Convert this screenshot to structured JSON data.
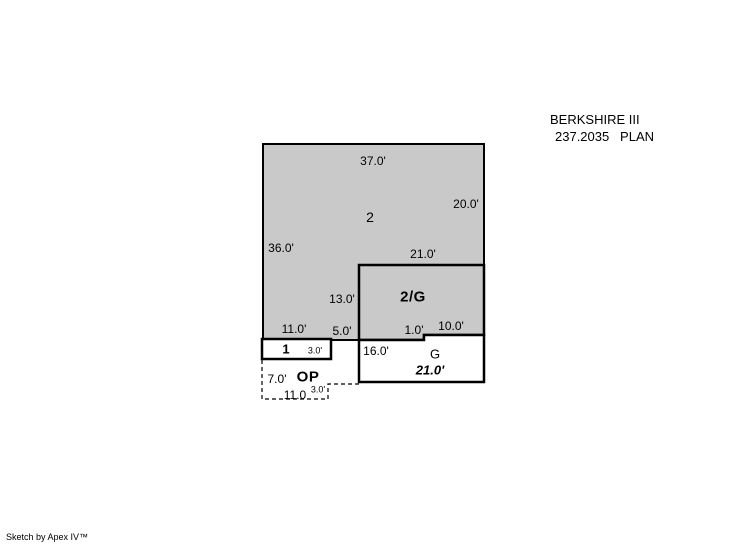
{
  "header": {
    "model_name": "BERKSHIRE III",
    "plan_line": "237.2035   PLAN"
  },
  "footer": {
    "credit": "Sketch by Apex IV™"
  },
  "colors": {
    "area_fill": "#c9c9c9",
    "open_fill": "#ffffff",
    "line": "#000000"
  },
  "areas": {
    "main_floor": "2",
    "over_garage": "2/G",
    "porch": "1",
    "garage": "G",
    "open_porch": "OP"
  },
  "dims": {
    "top_width": "37.0'",
    "right_upper": "20.0'",
    "left_height": "36.0'",
    "og_top": "21.0'",
    "og_left": "13.0'",
    "porch_top": "11.0'",
    "ledge": "5.0'",
    "step": "1.0'",
    "g_top_right": "10.0'",
    "porch_height": "3.0'",
    "g_left": "16.0'",
    "g_bottom": "21.0'",
    "op_left": "7.0'",
    "op_bottom": "11.0",
    "op_step": "3.0'"
  }
}
